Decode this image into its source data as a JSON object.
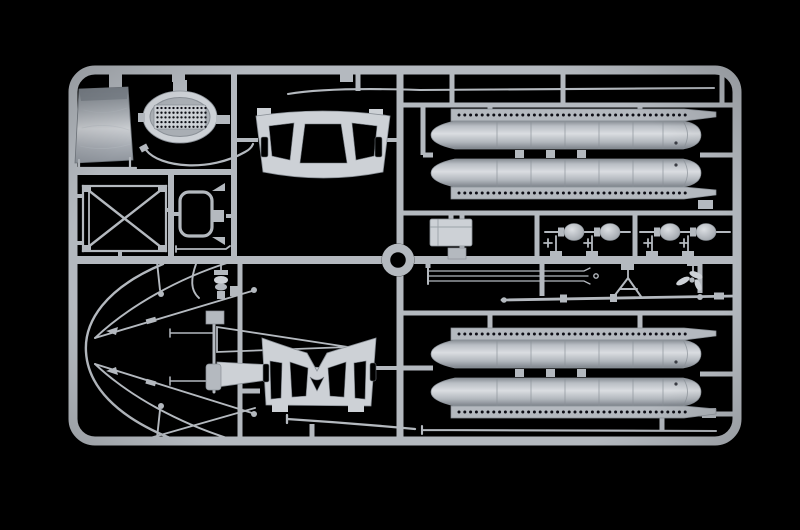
{
  "scene": {
    "description": "Photograph of an injection-moulded plastic model kit sprue with unpainted light grey parts on a black background",
    "subject": "model-kit-sprue",
    "background_color": "#000000",
    "plastic_color_name": "light grey"
  },
  "colors": {
    "background": "#000000",
    "plastic": "#b4b9bf",
    "plastic_light": "#cdd1d6",
    "plastic_mid": "#a9aeb4",
    "plastic_dark": "#8b9198",
    "plastic_deep": "#70767d",
    "hole": "#0d0f12"
  },
  "sprue": {
    "frame": {
      "x": 73,
      "y": 70,
      "width": 664,
      "height": 371,
      "corner_radius": 22,
      "runner_thickness": 9
    },
    "center_ring": {
      "cx": 398,
      "cy": 260,
      "outer_radius": 16.5,
      "inner_radius": 8
    }
  },
  "hole_rows": {
    "flange_top": {
      "x": 459,
      "y": 115,
      "count": 40,
      "spacing": 5.8,
      "r": 1.5
    },
    "flange_bottom": {
      "x": 459,
      "y": 193,
      "count": 40,
      "spacing": 5.8,
      "r": 1.5
    }
  },
  "grille_dots": {
    "x": 157.5,
    "y": 108,
    "cols": 13,
    "rows": 5,
    "dx": 4.0,
    "dy": 4.7,
    "r": 1.15
  },
  "counts": {
    "float_halves": 4,
    "flange_holes_per_float": 40,
    "bulb_floats": 4,
    "windshield_front_windows": 3,
    "windshield_gull_windows": 4,
    "rigging_rods": 3
  },
  "parts": [
    {
      "name": "canvas-tarp-panel",
      "description": "Wrinkled canvas cover panel, top left"
    },
    {
      "name": "oval-grille-hatch",
      "description": "Oval hatch with perforated grille mesh"
    },
    {
      "name": "grab-wire",
      "description": "Thin curved grab handle wire under grille"
    },
    {
      "name": "cross-brace-frame",
      "description": "Rectangular frame with X cross bracing"
    },
    {
      "name": "hoop-bracket",
      "description": "Rounded rectangular hoop bracket with tabs"
    },
    {
      "name": "windshield-front-frame",
      "description": "Curved windscreen frame, three windows and two side slots"
    },
    {
      "name": "gull-wing-windshield-frame",
      "description": "Gull-wing windscreen frame with central V, four windows"
    },
    {
      "name": "antenna-rod-long",
      "description": "Long thin antenna strip along top edge"
    },
    {
      "name": "float-halves-top-pair",
      "description": "Pair of long float halves with riveted flanges, upper right"
    },
    {
      "name": "float-halves-bottom-pair",
      "description": "Pair of long float halves with riveted flanges, lower right"
    },
    {
      "name": "equipment-box",
      "description": "Small rectangular equipment box with lid"
    },
    {
      "name": "bulb-float-row",
      "description": "Four small bulb-shaped wingtip floats on stems"
    },
    {
      "name": "rigging-rod-set",
      "description": "Set of three thin parallel rigging rods"
    },
    {
      "name": "mast-pole-with-davit",
      "description": "Long tapered mast pole with A-frame davit"
    },
    {
      "name": "propeller-part",
      "description": "Small three-blade propeller"
    },
    {
      "name": "rigging-wires-curved",
      "description": "Large curved rigging wires, lower left"
    },
    {
      "name": "tail-fin-pair",
      "description": "Two slender tail fins, one open outline, one solid"
    },
    {
      "name": "beaded-insulator-stack",
      "description": "Small stacked-bead fitting"
    },
    {
      "name": "mounting-pads",
      "description": "Small square mounting pads"
    },
    {
      "name": "wing-strip",
      "description": "Thin curved wing strip below gull-wing frame"
    },
    {
      "name": "center-ring-locator",
      "description": "Round locator ring at sprue centre"
    }
  ]
}
